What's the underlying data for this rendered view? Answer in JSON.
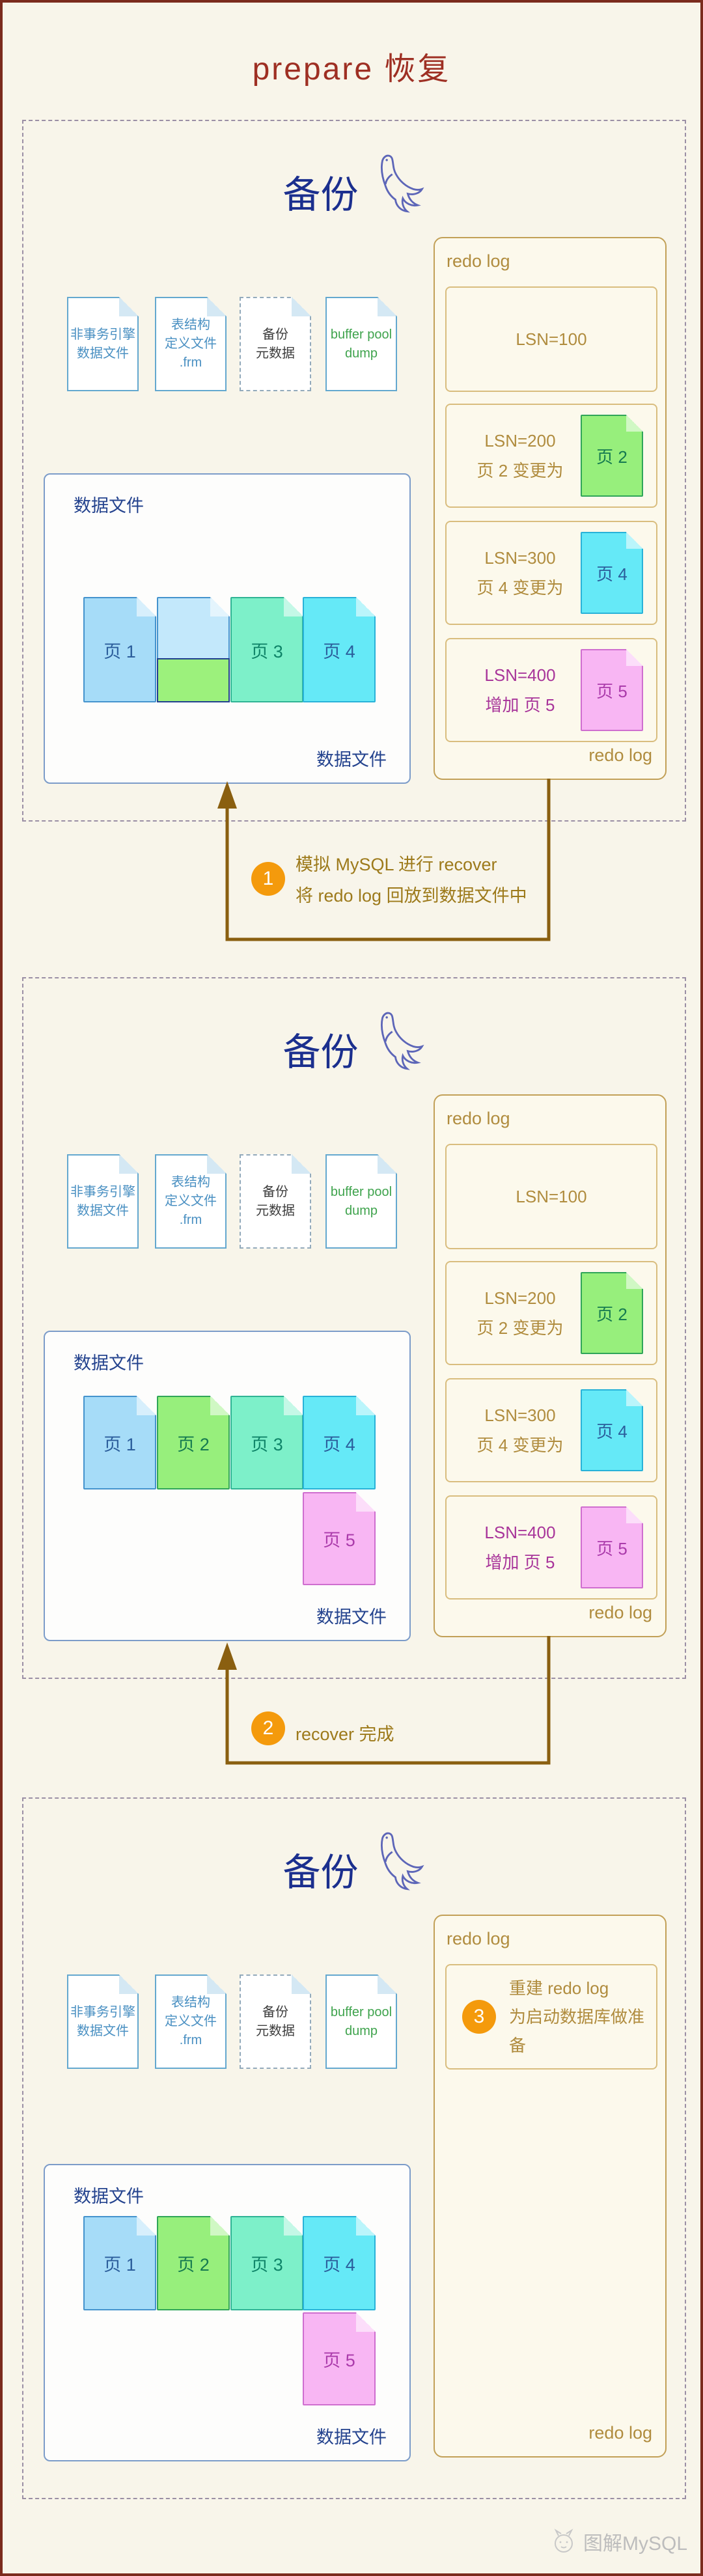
{
  "title": "prepare 恢复",
  "watermark": "图解MySQL",
  "colors": {
    "title_red": "#9e2f23",
    "header_navy": "#1b2f8e",
    "redo_gold": "#b08c3e",
    "lsn400_purple": "#a8359a",
    "step_orange": "#f49a0c",
    "arrow_brown": "#8a5f10",
    "datafile_navy": "#24438e",
    "page_blue": "#a6dcf8",
    "page_green": "#97ef7c",
    "page_teal": "#7df0c9",
    "page_cyan": "#65e9f7",
    "page_pink": "#f8b6f3",
    "doc_blue_text": "#4a90c2",
    "doc_green_text": "#3fa34d"
  },
  "steps": [
    {
      "num": "1",
      "line1": "模拟 MySQL 进行 recover",
      "line2": "将 redo log 回放到数据文件中"
    },
    {
      "num": "2",
      "line1": "recover 完成",
      "line2": ""
    },
    {
      "num": "3",
      "line1": "重建 redo log",
      "line2": "为启动数据库做准备"
    }
  ],
  "panels": [
    {
      "header": "备份",
      "docs": [
        {
          "line1": "非事务引擎",
          "line2": "数据文件"
        },
        {
          "line1": "表结构",
          "line2": "定义文件",
          "line3": ".frm"
        },
        {
          "line1": "备份",
          "line2": "元数据"
        },
        {
          "line1": "buffer pool",
          "line2": "dump"
        }
      ],
      "datafile": {
        "label_top": "数据文件",
        "label_bottom": "数据文件",
        "pages": [
          {
            "label": "页 1"
          },
          {
            "label": ""
          },
          {
            "label": "页 3"
          },
          {
            "label": "页 4"
          }
        ]
      },
      "redolog": {
        "label_top": "redo log",
        "label_bottom": "redo log",
        "entries": [
          {
            "line1": "LSN=100",
            "line2": "",
            "page_label": ""
          },
          {
            "line1": "LSN=200",
            "line2": "页 2 变更为",
            "page_label": "页 2"
          },
          {
            "line1": "LSN=300",
            "line2": "页 4 变更为",
            "page_label": "页 4"
          },
          {
            "line1": "LSN=400",
            "line2": "增加 页 5",
            "page_label": "页 5"
          }
        ]
      }
    },
    {
      "header": "备份",
      "docs": [
        {
          "line1": "非事务引擎",
          "line2": "数据文件"
        },
        {
          "line1": "表结构",
          "line2": "定义文件",
          "line3": ".frm"
        },
        {
          "line1": "备份",
          "line2": "元数据"
        },
        {
          "line1": "buffer pool",
          "line2": "dump"
        }
      ],
      "datafile": {
        "label_top": "数据文件",
        "label_bottom": "数据文件",
        "pages": [
          {
            "label": "页 1"
          },
          {
            "label": "页 2"
          },
          {
            "label": "页 3"
          },
          {
            "label": "页 4"
          },
          {
            "label": "页 5"
          }
        ]
      },
      "redolog": {
        "label_top": "redo log",
        "label_bottom": "redo log",
        "entries": [
          {
            "line1": "LSN=100",
            "line2": "",
            "page_label": ""
          },
          {
            "line1": "LSN=200",
            "line2": "页 2 变更为",
            "page_label": "页 2"
          },
          {
            "line1": "LSN=300",
            "line2": "页 4 变更为",
            "page_label": "页 4"
          },
          {
            "line1": "LSN=400",
            "line2": "增加 页 5",
            "page_label": "页 5"
          }
        ]
      }
    },
    {
      "header": "备份",
      "docs": [
        {
          "line1": "非事务引擎",
          "line2": "数据文件"
        },
        {
          "line1": "表结构",
          "line2": "定义文件",
          "line3": ".frm"
        },
        {
          "line1": "备份",
          "line2": "元数据"
        },
        {
          "line1": "buffer pool",
          "line2": "dump"
        }
      ],
      "datafile": {
        "label_top": "数据文件",
        "label_bottom": "数据文件",
        "pages": [
          {
            "label": "页 1"
          },
          {
            "label": "页 2"
          },
          {
            "label": "页 3"
          },
          {
            "label": "页 4"
          },
          {
            "label": "页 5"
          }
        ]
      },
      "redolog": {
        "label_top": "redo log",
        "label_bottom": "redo log"
      }
    }
  ]
}
